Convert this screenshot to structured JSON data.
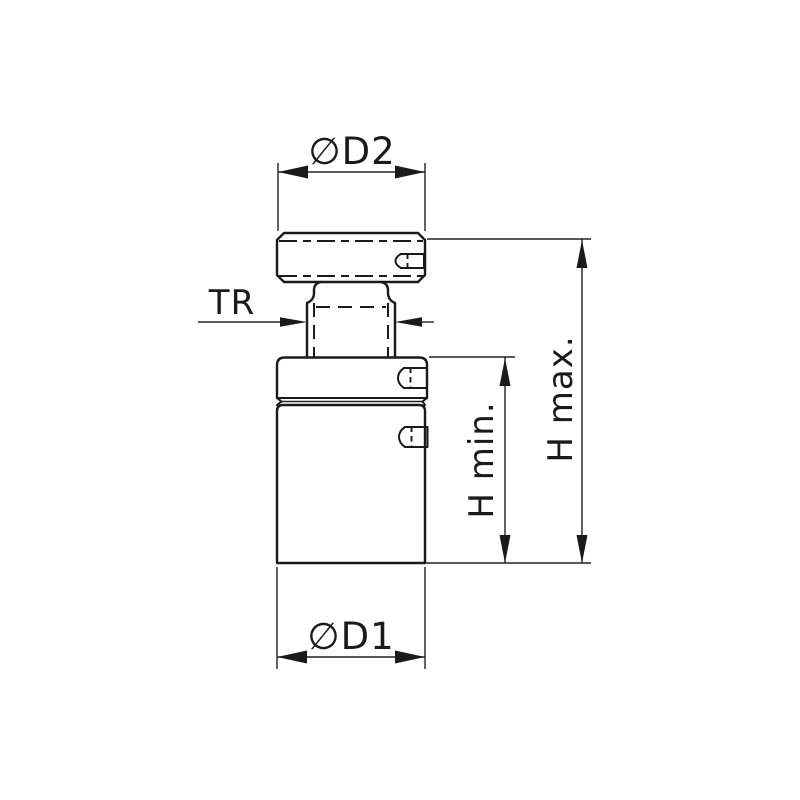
{
  "colors": {
    "background": "#ffffff",
    "line": "#1a1a1a"
  },
  "dimensions": {
    "d2": {
      "label": "∅D2"
    },
    "tr": {
      "label": "TR"
    },
    "h_min": {
      "label": "H min."
    },
    "h_max": {
      "label": "H max."
    },
    "d1": {
      "label": "∅D1"
    }
  }
}
